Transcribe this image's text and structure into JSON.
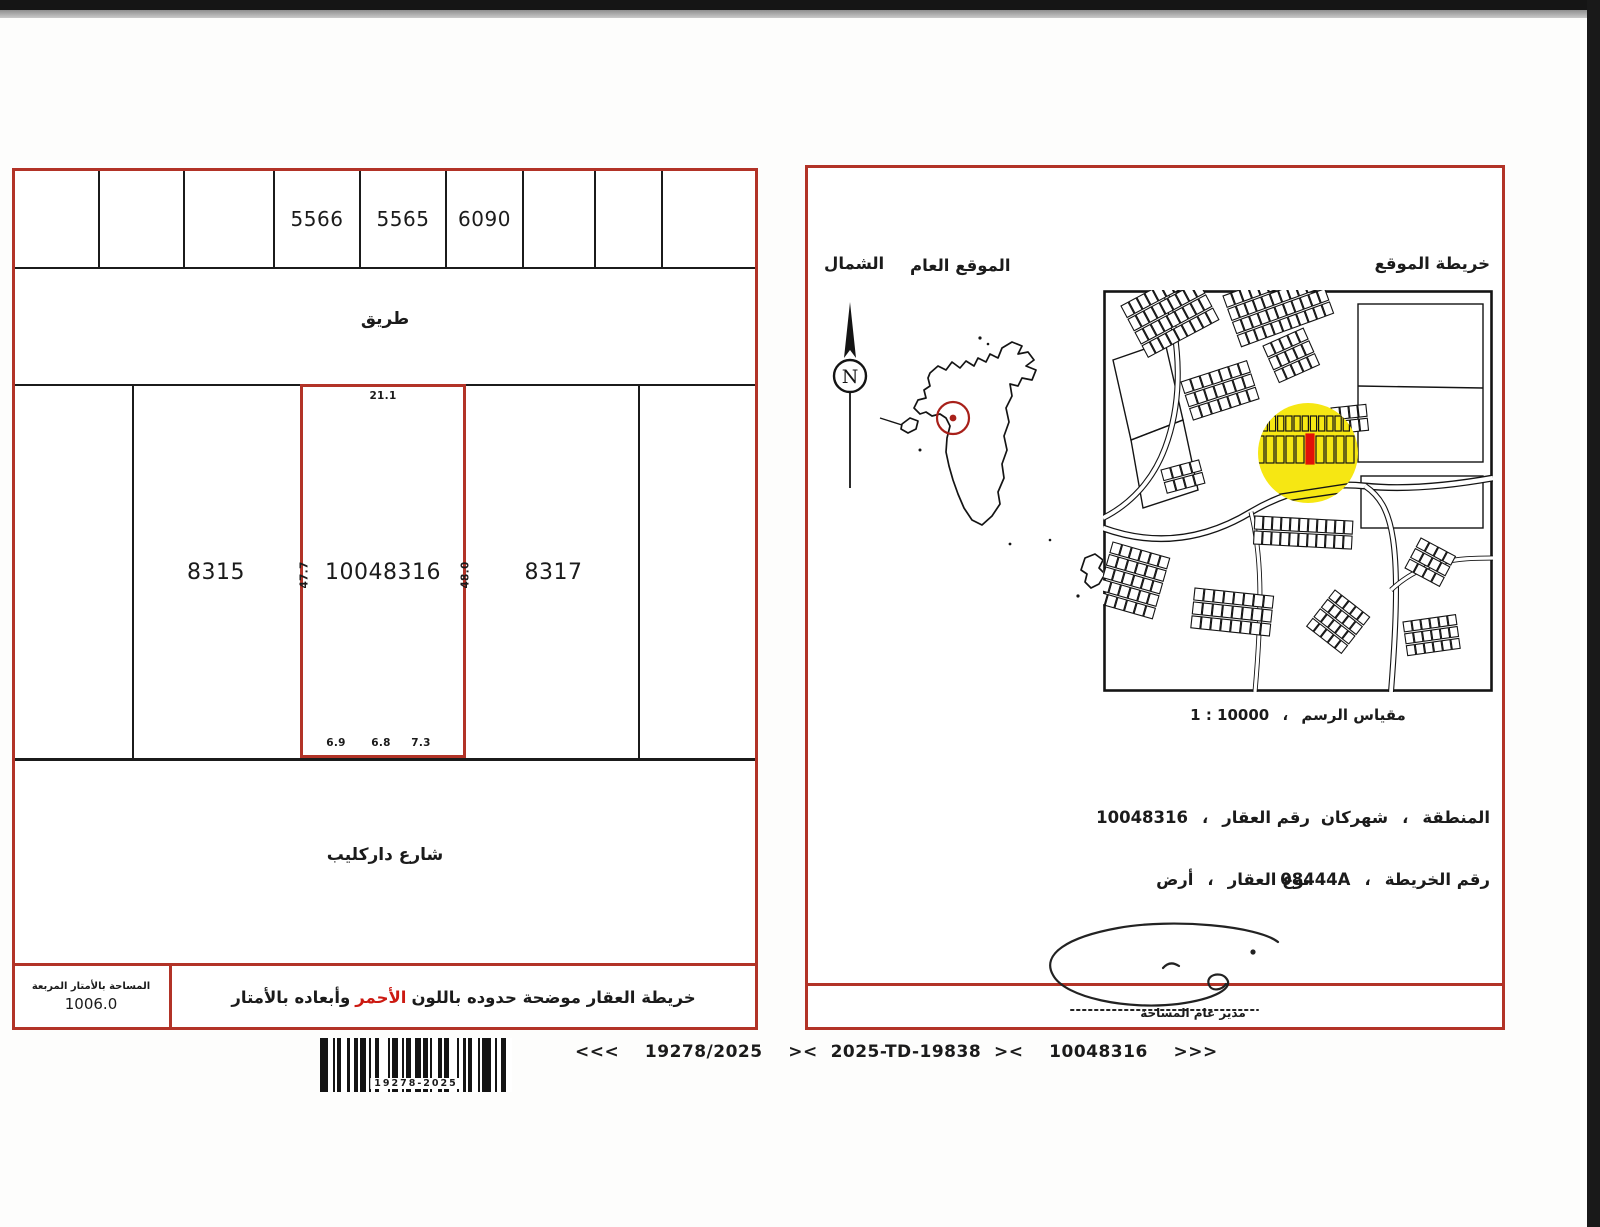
{
  "colors": {
    "border_red": "#b23327",
    "accent_red": "#cc1a12",
    "highlight_yellow": "#f6e713",
    "marker_red": "#e11008",
    "ink": "#1b1b1b"
  },
  "left_panel": {
    "top_plots": {
      "labels": [
        "",
        "",
        "",
        "5566",
        "5565",
        "6090",
        "",
        "",
        ""
      ]
    },
    "road_label": "طريق",
    "middle_plots": {
      "left_label": "8315",
      "center_label": "10048316",
      "right_label": "8317"
    },
    "dimensions": {
      "top": "21.1",
      "left_side": "47.7",
      "right_side": "48.0",
      "bottom": [
        "6.9",
        "6.8",
        "7.3"
      ]
    },
    "street_label": "شارع داركليب",
    "area_box": {
      "label": "المساحة بالأمتار المربعة",
      "value": "1006.0"
    },
    "note": {
      "prefix": "خريطة العقار موضحة حدوده باللون",
      "highlight": "الأحمر",
      "suffix": "وأبعاده بالأمتار"
    }
  },
  "right_panel": {
    "north_label": "الشمال",
    "compass_letter": "N",
    "general_location_label": "الموقع العام",
    "location_map_label": "خريطة الموقع",
    "scale": {
      "label": "مقياس الرسم",
      "sep": "،",
      "value": "1 : 10000"
    },
    "fields": [
      {
        "label": "رقم العقار",
        "sep": "،",
        "value": "10048316"
      },
      {
        "label": "المنطقة",
        "sep": "،",
        "value": "شهركان"
      },
      {
        "label": "نوع العقار",
        "sep": "،",
        "value": "أرض"
      },
      {
        "label": "رقم الخريطة",
        "sep": "،",
        "value": "08444A"
      }
    ],
    "signatory_title": "مدير عام المساحة"
  },
  "footer": {
    "barcode_label": "19278-2025",
    "reference": "<<<    19278/2025    ><  2025-TD-19838  ><    10048316    >>>"
  }
}
